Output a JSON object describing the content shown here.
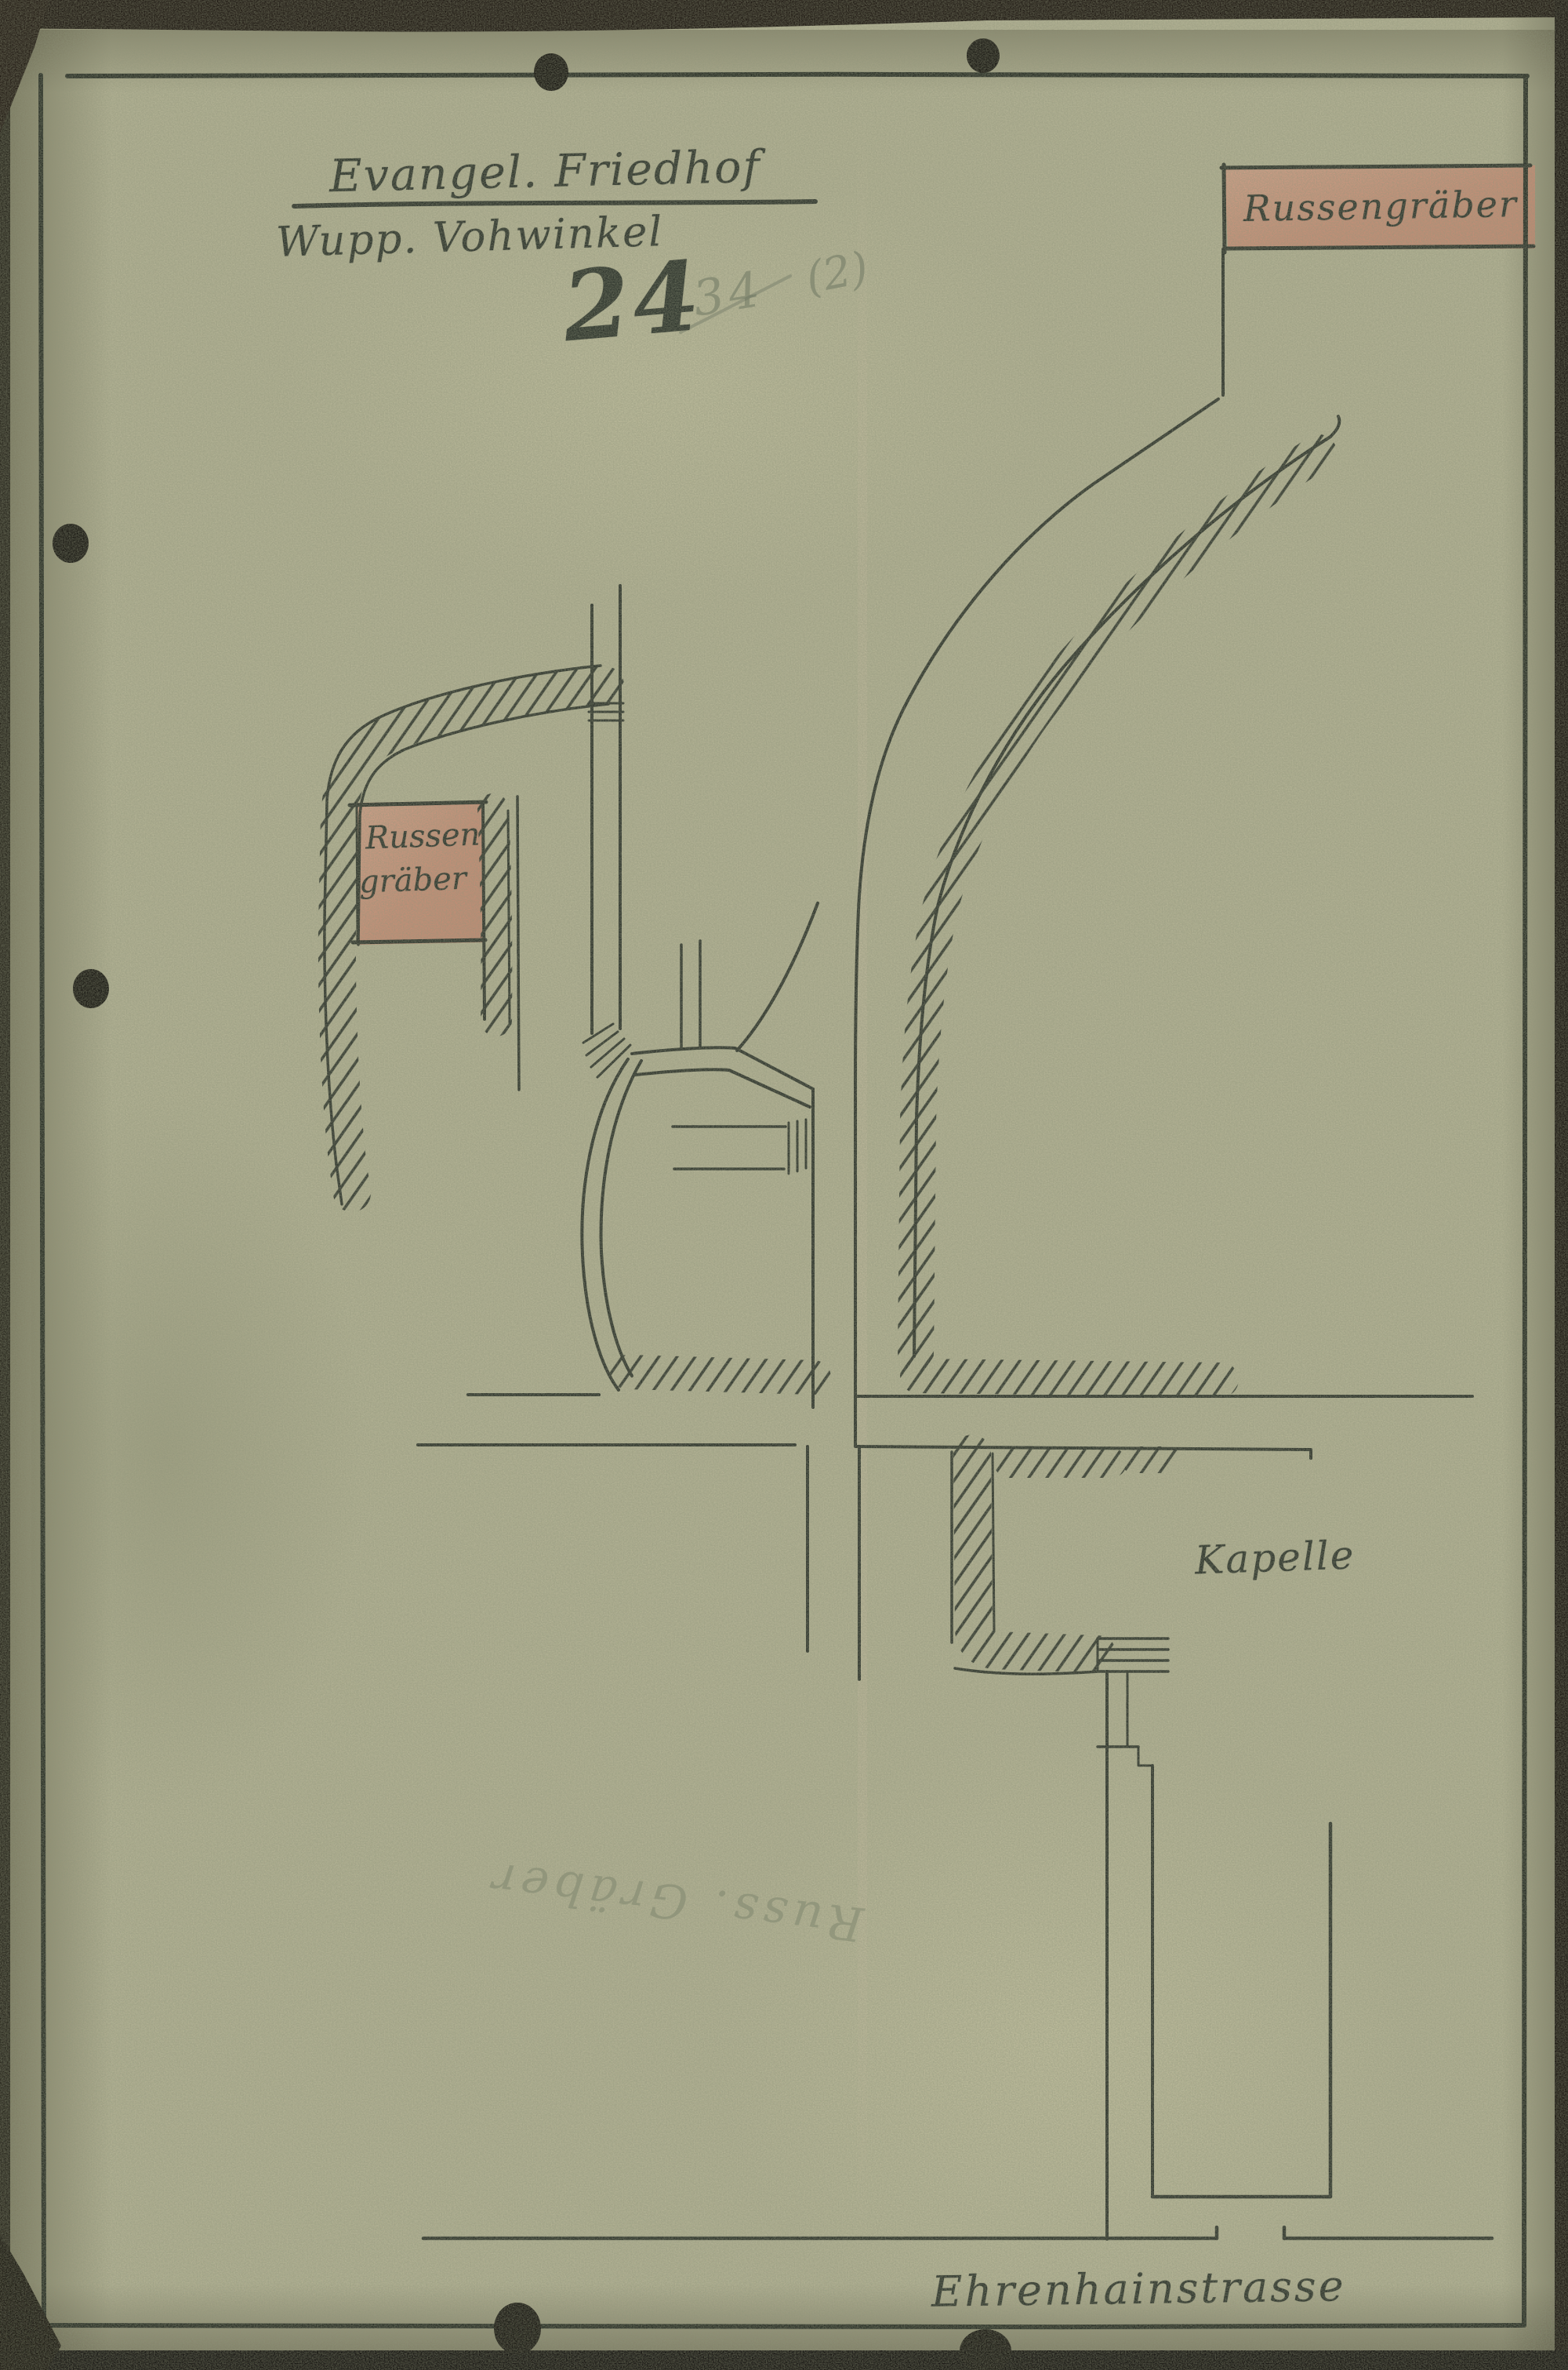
{
  "header": {
    "title_line1": "Evangel. Friedhof",
    "title_line2": "Wupp. Vohwinkel",
    "sheet_number": "24",
    "pencil_number_struck": "34",
    "pencil_suffix": "(2)"
  },
  "labels": {
    "russengraeber_top": "Russengräber",
    "russengraeber_left_line1": "Russen",
    "russengraeber_left_line2": "gräber",
    "kapelle": "Kapelle",
    "street": "Ehrenhainstrasse",
    "pencil_reversed_note": "Russ. Gräber"
  },
  "colors": {
    "paper": "#b5b496",
    "ink": "#262c26",
    "highlight_pink": "#cf8f79",
    "pencil_gray": "#6b7a6b",
    "scan_edge_dark": "#140d09"
  }
}
